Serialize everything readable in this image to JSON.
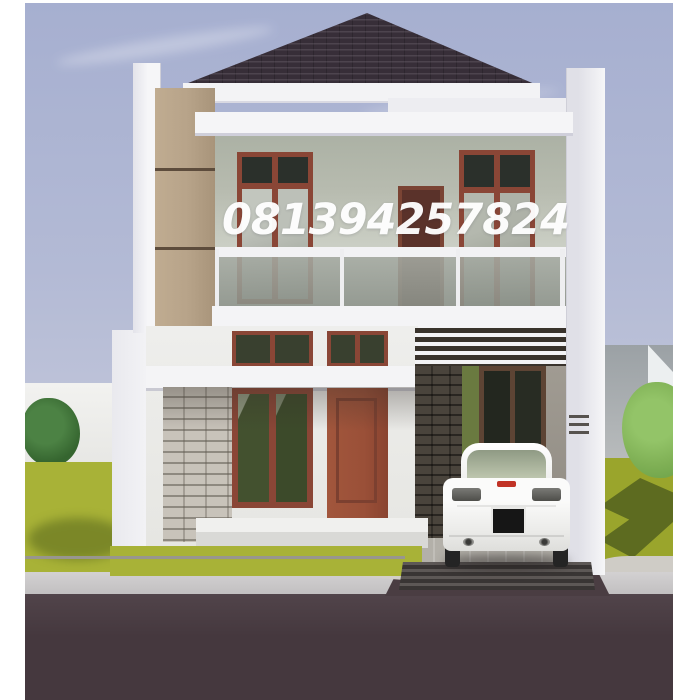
{
  "watermark": {
    "text": "081394257824"
  },
  "scene": {
    "type": "3d-architecture-exterior-render",
    "subject": "modern two-storey minimalist house",
    "features": [
      "dark hip roof",
      "tan accent panel",
      "glass balcony railing",
      "wood-framed windows",
      "carport with white pergola slats",
      "white sedan parked in carport",
      "stone-clad pillar",
      "lawn with trees",
      "sidewalk and asphalt street"
    ]
  },
  "colors": {
    "sky_top": "#a6afd0",
    "sky_bottom": "#c9ccdc",
    "roof": "#372e38",
    "accent_panel": "#b7a389",
    "upper_wall_shadow": "#aeb2a6",
    "upper_wall_light": "#d6dad0",
    "white_trim": "#f4f4f6",
    "window_frame": "#8a4636",
    "door": "#9a5038",
    "dark_glass": "#39402f",
    "balcony_glass": "#969b94",
    "stone_pillar": "#c8c3ba",
    "carport_gap": "#39332c",
    "grass": "#a8b237",
    "grass_dark": "#5d6b20",
    "sidewalk": "#c7c5c6",
    "street": "#473a40",
    "car_body": "#f4f4f2",
    "brake_light": "#c13326"
  }
}
